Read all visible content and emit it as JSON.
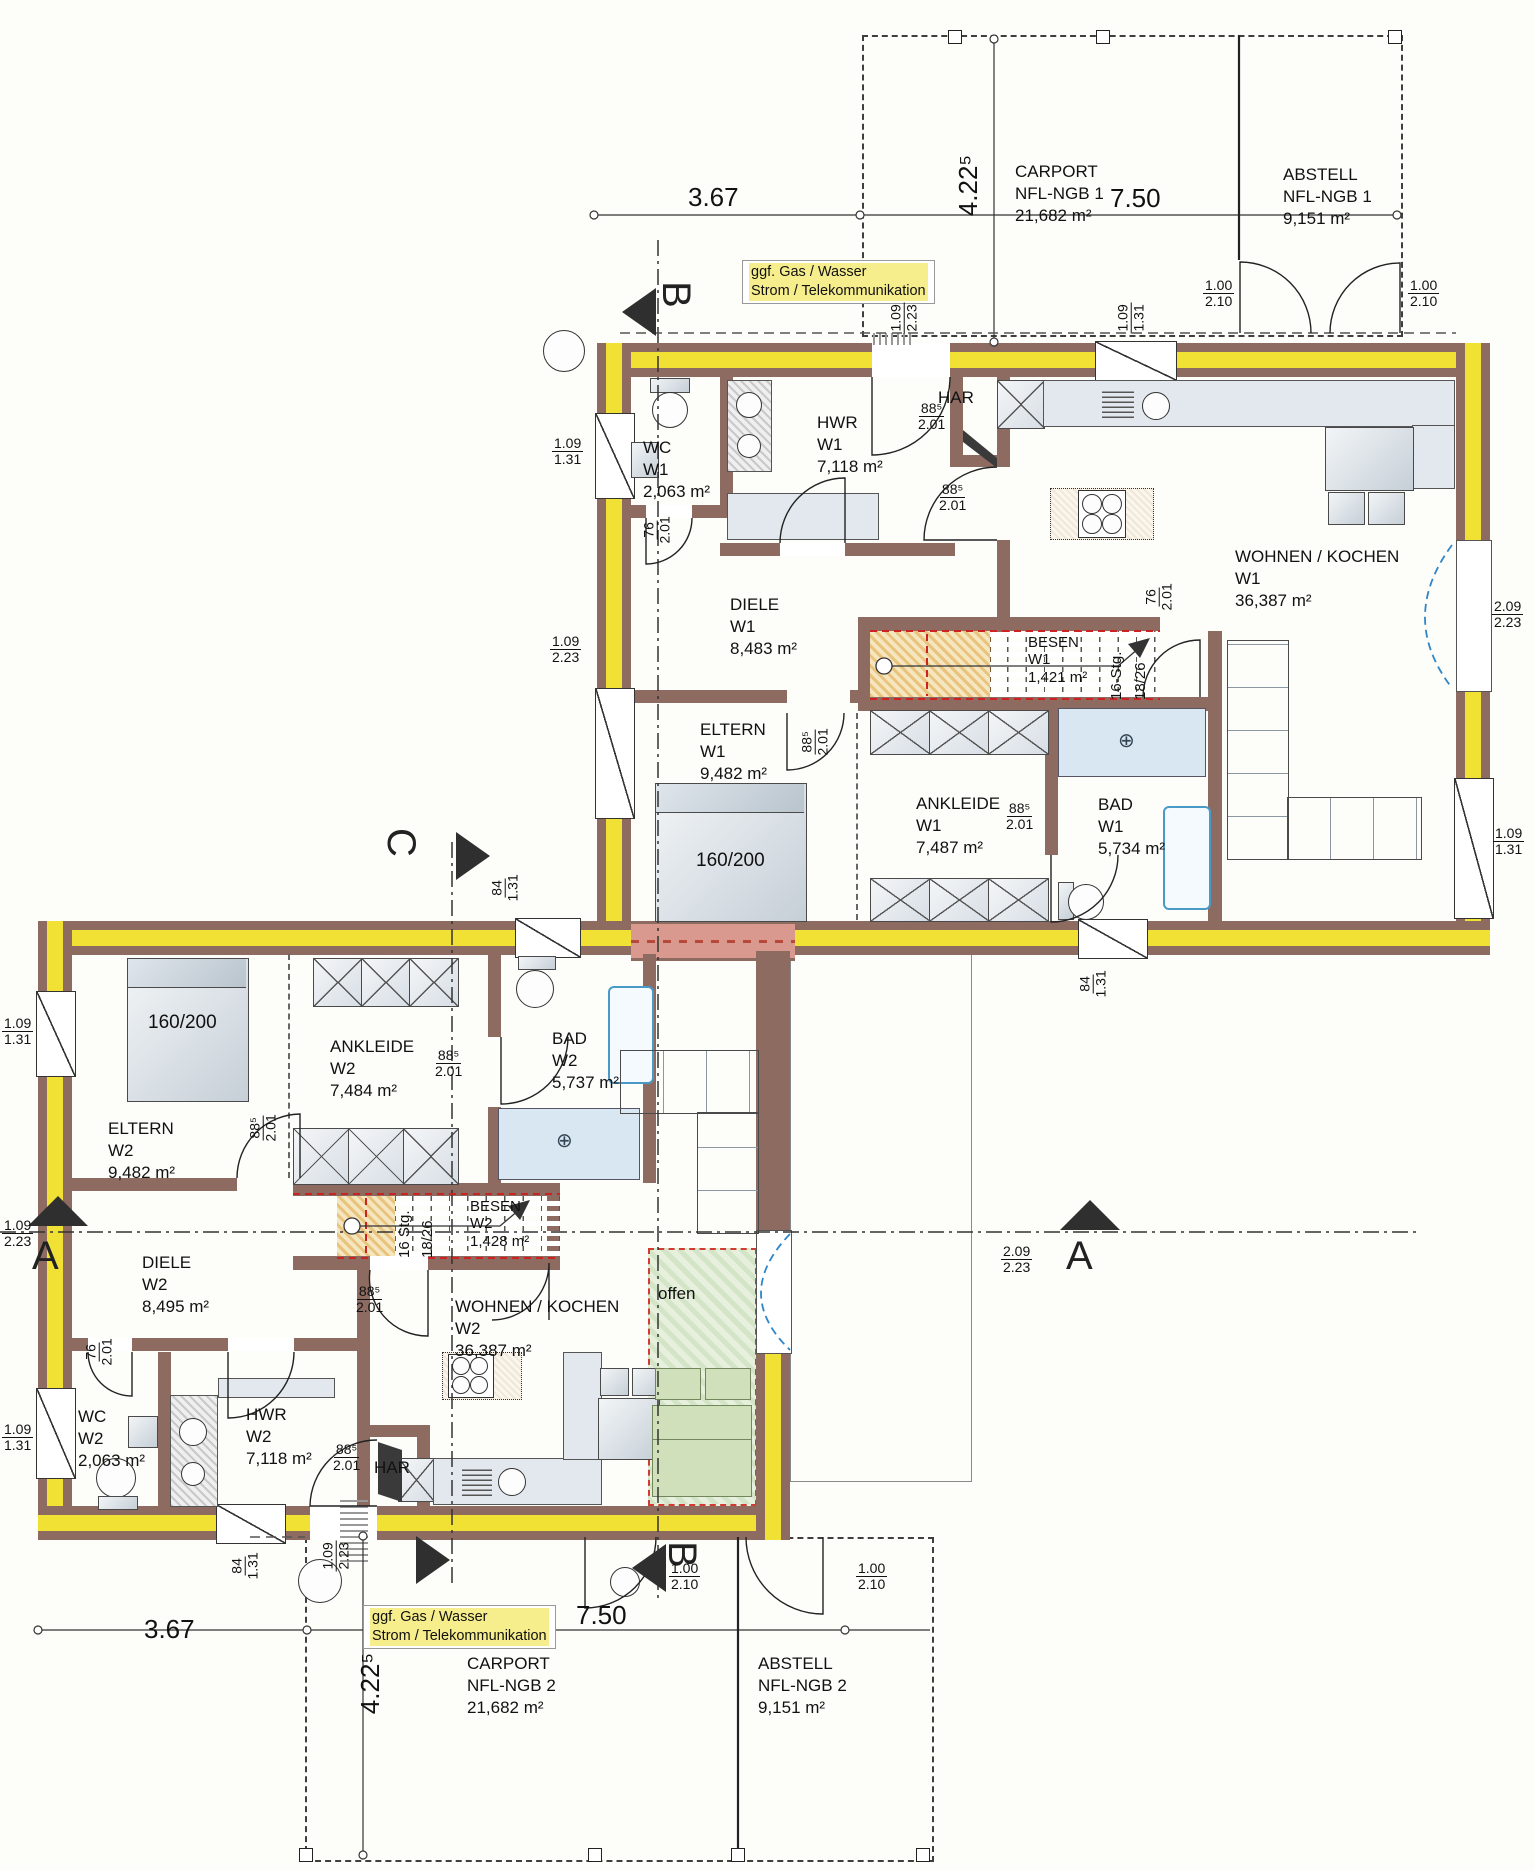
{
  "dims": {
    "w885": "88⁵",
    "h201": "2.01",
    "w76": "76",
    "w84": "84",
    "h131": "1.31",
    "w109": "1.09",
    "h223": "2.23",
    "w100": "1.00",
    "h210": "2.10",
    "w209": "2.09",
    "len367": "3.67",
    "len750": "7.50",
    "len422": "4.22⁵"
  },
  "rooms": {
    "wc1": {
      "name": "WC",
      "unit": "W1",
      "area": "2,063 m²"
    },
    "hwr1": {
      "name": "HWR",
      "unit": "W1",
      "area": "7,118 m²"
    },
    "diele1": {
      "name": "DIELE",
      "unit": "W1",
      "area": "8,483 m²"
    },
    "wohnen1": {
      "name": "WOHNEN / KOCHEN",
      "unit": "W1",
      "area": "36,387 m²"
    },
    "eltern1": {
      "name": "ELTERN",
      "unit": "W1",
      "area": "9,482 m²"
    },
    "ankleide1": {
      "name": "ANKLEIDE",
      "unit": "W1",
      "area": "7,487 m²"
    },
    "bad1": {
      "name": "BAD",
      "unit": "W1",
      "area": "5,734 m²"
    },
    "besen1": {
      "name": "BESEN",
      "unit": "W1",
      "area": "1,421 m²"
    },
    "wc2": {
      "name": "WC",
      "unit": "W2",
      "area": "2,063 m²"
    },
    "hwr2": {
      "name": "HWR",
      "unit": "W2",
      "area": "7,118 m²"
    },
    "diele2": {
      "name": "DIELE",
      "unit": "W2",
      "area": "8,495 m²"
    },
    "wohnen2": {
      "name": "WOHNEN / KOCHEN",
      "unit": "W2",
      "area": "36,387 m²"
    },
    "eltern2": {
      "name": "ELTERN",
      "unit": "W2",
      "area": "9,482 m²"
    },
    "ankleide2": {
      "name": "ANKLEIDE",
      "unit": "W2",
      "area": "7,484 m²"
    },
    "bad2": {
      "name": "BAD",
      "unit": "W2",
      "area": "5,737 m²"
    },
    "besen2": {
      "name": "BESEN",
      "unit": "W2",
      "area": "1,428 m²"
    }
  },
  "har": "HAR",
  "offen": "offen",
  "bed_size": "160/200",
  "stairs": {
    "w1": {
      "steps": "16-Stg.",
      "ratio": "18/26"
    },
    "w2": {
      "steps": "16 Stg.",
      "ratio": "18/26"
    }
  },
  "outbuildings": {
    "carport1": {
      "name": "CARPORT",
      "id": "NFL-NGB 1",
      "area": "21,682 m²"
    },
    "abstell1": {
      "name": "ABSTELL",
      "id": "NFL-NGB 1",
      "area": "9,151 m²"
    },
    "carport2": {
      "name": "CARPORT",
      "id": "NFL-NGB 2",
      "area": "21,682 m²"
    },
    "abstell2": {
      "name": "ABSTELL",
      "id": "NFL-NGB 2",
      "area": "9,151 m²"
    }
  },
  "utility_note": {
    "line1": "ggf. Gas / Wasser",
    "line2": "Strom / Telekommunikation"
  },
  "sections": {
    "a": "A",
    "b": "B",
    "c": "C"
  },
  "colors": {
    "wall": "#8d6b61",
    "insulation": "#f2e135",
    "party_wall": "#d9998f",
    "stair_wood": "#e8c27a",
    "terrace_green": "#dcead2",
    "window_arc_blue": "#2e86c8",
    "section_red": "#cc2222"
  }
}
